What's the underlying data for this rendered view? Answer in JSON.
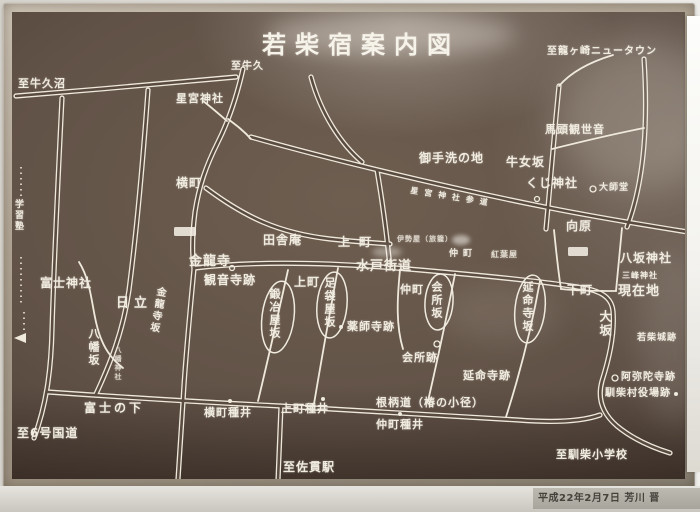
{
  "title": "若柴宿案内図",
  "credit": "平成22年2月7日 芳川 晋",
  "colors": {
    "board_dark": "#3a2e27",
    "board_mid": "#5d4e43",
    "line": "#efe9dc",
    "frame": "#b3a897",
    "plate": "#b2afa7"
  },
  "labels": {
    "to_ushikunuma": "至牛久沼",
    "to_ushiku": "至牛久",
    "hoshinomiya_jinja": "星宮神社",
    "to_ryugasaki_nt": "至龍ヶ崎ニュータウン",
    "bato_kanzeon": "馬頭観世音",
    "mitarashi_no_chi": "御手洗の地",
    "ushime_zaka": "牛女坂",
    "kuji_jinja": "くじ神社",
    "hoshinomiya_sando": "星宮神社参道",
    "yokomachi": "横町",
    "daishido": "大師堂",
    "mukaihara": "向原",
    "yasaka_jinja": "八坂神社",
    "mitsumine_jinja": "三峰神社",
    "genzaichi": "現在地",
    "shimomachi": "下町",
    "osaka": "大坂",
    "wakashiba_joseki": "若柴城跡",
    "inakaan": "田舎庵",
    "kamimachi_upper": "上町",
    "kamimachi": "上町",
    "mito_kaido": "水戸街道",
    "nakamachi_small": "仲町",
    "nakamachi": "仲町",
    "iseya": "伊勢屋（旅籠）",
    "momijiya": "紅葉屋",
    "kinryuji": "金龍寺",
    "kannonji_ato": "観音寺跡",
    "kinryuji_zaka": "金龍寺坂",
    "kajiya_zaka": "鍛冶屋坂",
    "tabiya_zaka": "足袋屋坂",
    "kaisho_zaka": "会所坂",
    "enmeiji_zaka": "延命寺坂",
    "yakushiji_ato": "薬師寺跡",
    "kaisho_ato": "会所跡",
    "enmeiji_ato": "延命寺跡",
    "fuji_jinja": "富士神社",
    "hitachi": "日立",
    "hachiman_zaka": "八幡坂",
    "hachiman_jinja": "八幡神社",
    "gakushujuku": "学習塾",
    "fuji_no_shita": "富士の下",
    "to_route6": "至6号国道",
    "yokomachi_tanei": "横町種井",
    "kamimachi_tanei": "上町種井",
    "negara_michi": "根柄道（椿の小径）",
    "nakamachi_tanei": "仲町種井",
    "to_sanuki_sta": "至佐貫駅",
    "to_narishiba_es": "至馴柴小学校",
    "amidaji_ato": "阿弥陀寺跡",
    "narishiba_yakuba_ato": "馴柴村役場跡"
  }
}
